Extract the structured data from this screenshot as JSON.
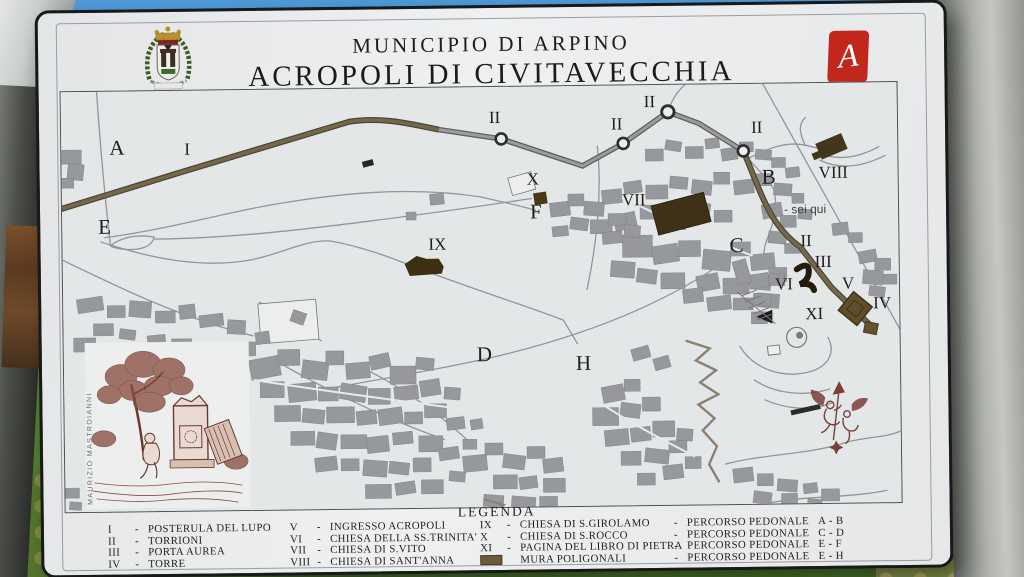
{
  "sign": {
    "title_line1": "MUNICIPIO DI ARPINO",
    "title_line2": "ACROPOLI DI CIVITAVECCHIA",
    "crest_name": "arpino-coat-of-arms",
    "logo": {
      "letter": "A",
      "label": "Archeo Club Arpino",
      "color": "#c2271b"
    },
    "credit_vertical": "MAURIZIO MASTROIANNI"
  },
  "legend": {
    "heading": "LEGENDA",
    "mura_color": "#6b5b38",
    "columns": [
      {
        "items": [
          {
            "num": "I",
            "name": "POSTERULA DEL LUPO"
          },
          {
            "num": "II",
            "name": "TORRIONI"
          },
          {
            "num": "III",
            "name": "PORTA AUREA"
          },
          {
            "num": "IV",
            "name": "TORRE"
          }
        ]
      },
      {
        "items": [
          {
            "num": "V",
            "name": "INGRESSO ACROPOLI"
          },
          {
            "num": "VI",
            "name": "CHIESA DELLA SS.TRINITA'"
          },
          {
            "num": "VII",
            "name": "CHIESA DI S.VITO"
          },
          {
            "num": "VIII",
            "name": "CHIESA DI SANT'ANNA"
          }
        ]
      },
      {
        "items": [
          {
            "num": "IX",
            "name": "CHIESA DI S.GIROLAMO"
          },
          {
            "num": "X",
            "name": "CHIESA DI S.ROCCO"
          },
          {
            "num": "XI",
            "name": "PAGINA DEL LIBRO DI PIETRA"
          },
          {
            "swatch": true,
            "name": "MURA POLIGONALI"
          }
        ]
      },
      {
        "items": [
          {
            "name": "PERCORSO PEDONALE",
            "route": "A - B"
          },
          {
            "name": "PERCORSO PEDONALE",
            "route": "C - D"
          },
          {
            "name": "PERCORSO PEDONALE",
            "route": "E - F"
          },
          {
            "name": "PERCORSO PEDONALE",
            "route": "E - H"
          }
        ]
      }
    ]
  },
  "map": {
    "colors": {
      "road": "#74674a",
      "wall": "#9c9c9c",
      "monument": "#3f3118",
      "building": "#97989b"
    },
    "labels": [
      {
        "text": "A",
        "x": 48,
        "y": 63,
        "cls": "big"
      },
      {
        "text": "I",
        "x": 123,
        "y": 64,
        "cls": "num"
      },
      {
        "text": "E",
        "x": 36,
        "y": 142,
        "cls": "big"
      },
      {
        "text": "II",
        "x": 428,
        "y": 36,
        "cls": "num"
      },
      {
        "text": "II",
        "x": 550,
        "y": 44,
        "cls": "num"
      },
      {
        "text": "II",
        "x": 583,
        "y": 22,
        "cls": "num"
      },
      {
        "text": "II",
        "x": 690,
        "y": 49,
        "cls": "num"
      },
      {
        "text": "X",
        "x": 465,
        "y": 98,
        "cls": "num"
      },
      {
        "text": "F",
        "x": 468,
        "y": 132,
        "cls": "big"
      },
      {
        "text": "VII",
        "x": 560,
        "y": 120,
        "cls": "num"
      },
      {
        "text": "B",
        "x": 700,
        "y": 100,
        "cls": "big"
      },
      {
        "text": "VIII",
        "x": 757,
        "y": 95,
        "cls": "num"
      },
      {
        "text": "- sei qui",
        "x": 722,
        "y": 130,
        "cls": "sq"
      },
      {
        "text": "C",
        "x": 667,
        "y": 168,
        "cls": "big"
      },
      {
        "text": "II",
        "x": 738,
        "y": 163,
        "cls": "num"
      },
      {
        "text": "III",
        "x": 752,
        "y": 184,
        "cls": "num"
      },
      {
        "text": "VI",
        "x": 712,
        "y": 206,
        "cls": "num"
      },
      {
        "text": "V",
        "x": 779,
        "y": 206,
        "cls": "num"
      },
      {
        "text": "IV",
        "x": 810,
        "y": 226,
        "cls": "num"
      },
      {
        "text": "XI",
        "x": 742,
        "y": 236,
        "cls": "num"
      },
      {
        "text": "IX",
        "x": 366,
        "y": 162,
        "cls": "num"
      },
      {
        "text": "D",
        "x": 413,
        "y": 274,
        "cls": "big"
      },
      {
        "text": "H",
        "x": 512,
        "y": 284,
        "cls": "big"
      }
    ]
  }
}
